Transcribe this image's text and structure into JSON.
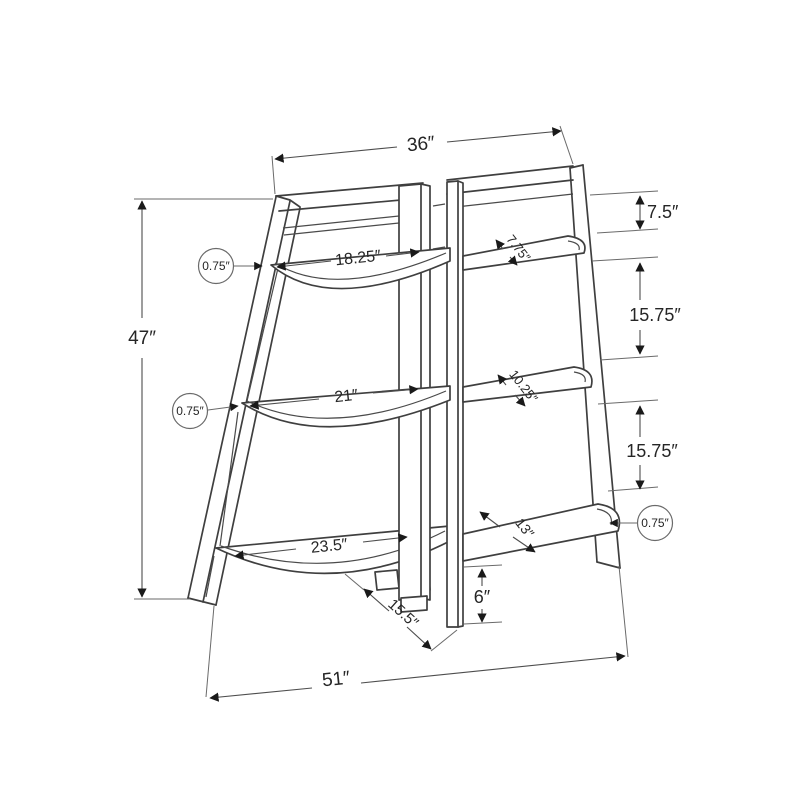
{
  "meta": {
    "background_color": "#ffffff",
    "line_color": "#3f3f3f",
    "dimension_line_color": "#4d4d4d",
    "text_color": "#262626",
    "drawing_type": "furniture dimension diagram",
    "subject": "3-tier corner ladder accent shelf"
  },
  "labels": {
    "top_width": "36″",
    "overall_height": "47″",
    "bottom_width": "51″",
    "top_shelf_gap": "7.5″",
    "upper_shelf_spacing": "15.75″",
    "lower_shelf_spacing": "15.75″",
    "front_shelf_top_width": "18.25″",
    "front_shelf_middle_width": "21″",
    "front_shelf_bottom_width": "23.5″",
    "side_shelf_top_depth": "7.75″",
    "side_shelf_middle_depth": "10.25″",
    "side_shelf_bottom_depth": "13″",
    "shelf_thickness_top": "0.75″",
    "shelf_thickness_middle": "0.75″",
    "shelf_thickness_side": "0.75″",
    "post_foot_height": "6″",
    "bottom_shelf_depth": "15.5″"
  }
}
